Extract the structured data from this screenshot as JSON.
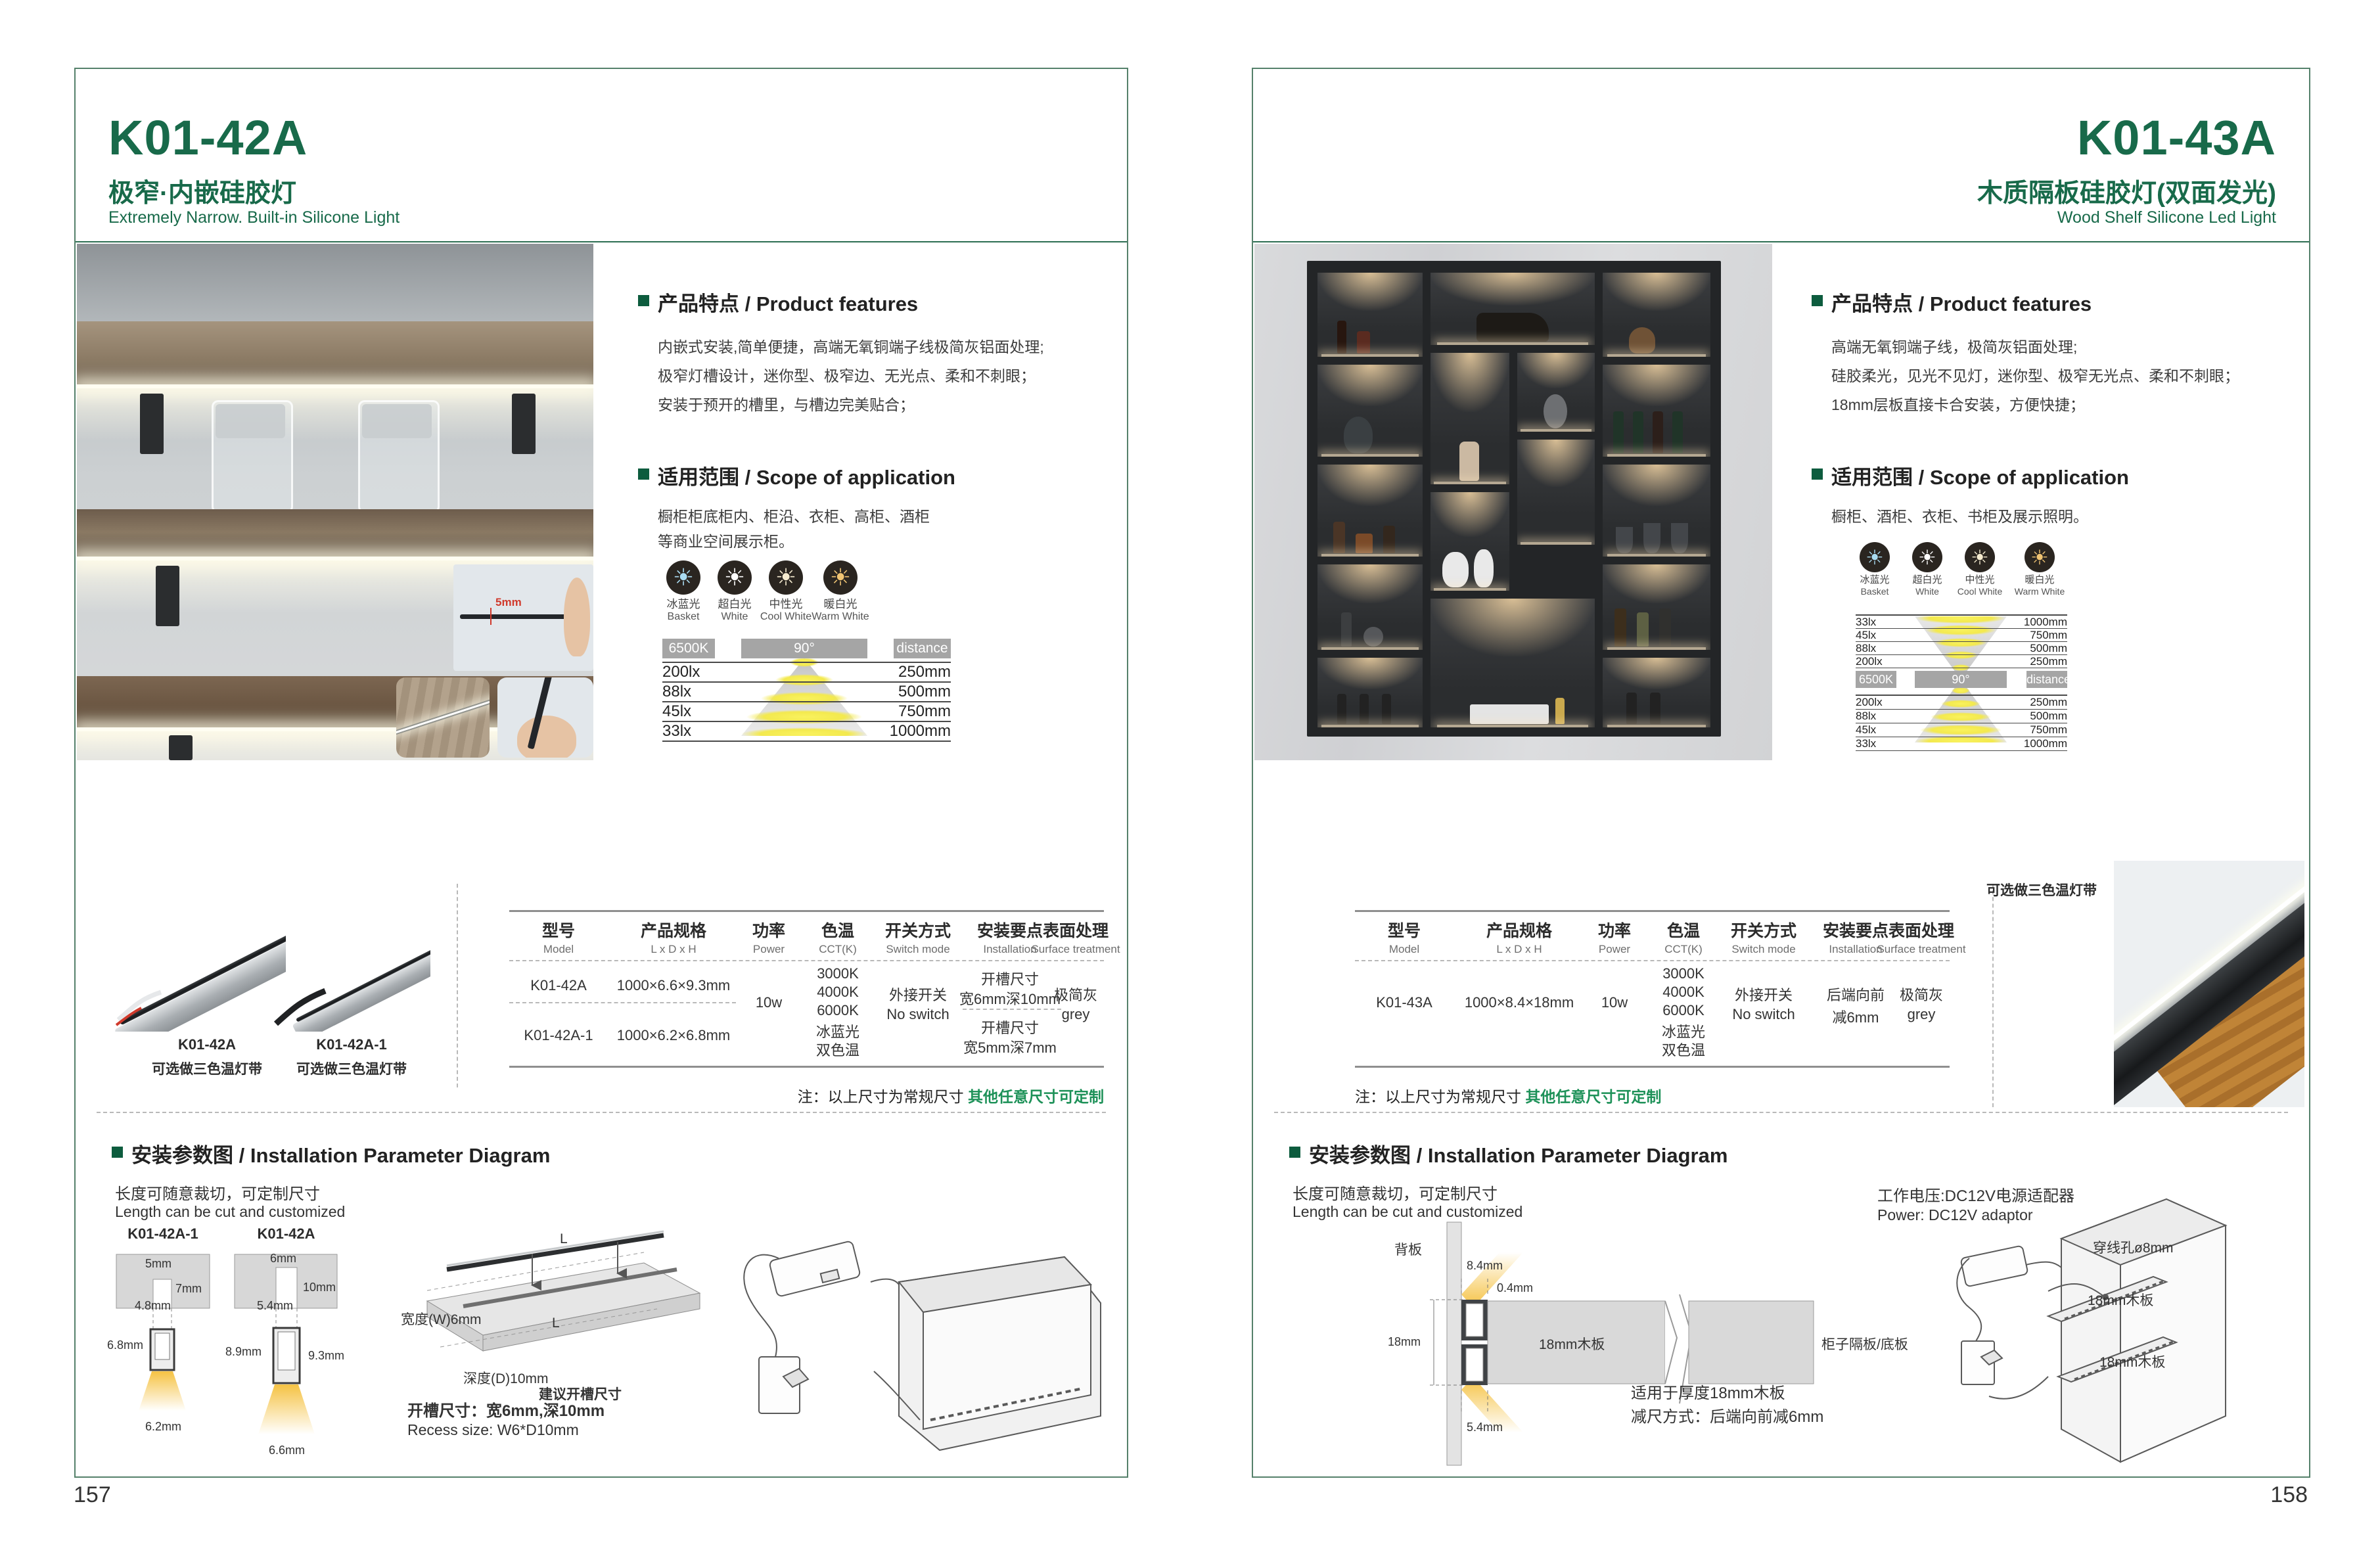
{
  "brand": {
    "accent_green": "#186a4a",
    "bullet_green": "#0d5c3e",
    "note_green": "#1d9158",
    "warm_light": "#f5c243"
  },
  "pages": [
    {
      "page_number": "157",
      "model": "K01-42A",
      "title_cn": "极窄·内嵌硅胶灯",
      "title_en": "Extremely Narrow. Built-in Silicone Light",
      "features": {
        "heading": "产品特点 / Product features",
        "lines": [
          "内嵌式安装,简单便捷，高端无氧铜端子线极简灰铝面处理;",
          "极窄灯槽设计，迷你型、极窄边、无光点、柔和不刺眼；",
          "安装于预开的槽里，与槽边完美贴合；"
        ]
      },
      "scope": {
        "heading": "适用范围 / Scope of application",
        "lines": [
          "橱柜柜底柜内、柜沿、衣柜、高柜、酒柜",
          "等商业空间展示柜。"
        ]
      },
      "photometric": {
        "icons": [
          {
            "cn": "冰蓝光",
            "en": "Basket",
            "color": "#a9dcf2"
          },
          {
            "cn": "超白光",
            "en": "White",
            "color": "#ffffff"
          },
          {
            "cn": "中性光",
            "en": "Cool White",
            "color": "#f6ecd0"
          },
          {
            "cn": "暖白光",
            "en": "Warm White",
            "color": "#f0c473"
          }
        ],
        "kelvin": "6500K",
        "angle": "90°",
        "distance_label": "distance",
        "rows": [
          {
            "lux": "200lx",
            "d": "250mm"
          },
          {
            "lux": "88lx",
            "d": "500mm"
          },
          {
            "lux": "45lx",
            "d": "750mm"
          },
          {
            "lux": "33lx",
            "d": "1000mm"
          }
        ]
      },
      "photo": {
        "inset_dim": "5mm"
      },
      "products": [
        {
          "model": "K01-42A",
          "note": "可选做三色温灯带"
        },
        {
          "model": "K01-42A-1",
          "note": "可选做三色温灯带"
        }
      ],
      "spec_table": {
        "headers": [
          {
            "cn": "型号",
            "en": "Model"
          },
          {
            "cn": "产品规格",
            "en": "L x D x H"
          },
          {
            "cn": "功率",
            "en": "Power"
          },
          {
            "cn": "色温",
            "en": "CCT(K)"
          },
          {
            "cn": "开关方式",
            "en": "Switch mode"
          },
          {
            "cn": "安装要点",
            "en": "Installation"
          },
          {
            "cn": "表面处理",
            "en": "Surface treatment"
          }
        ],
        "models": [
          "K01-42A",
          "K01-42A-1"
        ],
        "sizes": [
          "1000×6.6×9.3mm",
          "1000×6.2×6.8mm"
        ],
        "power": "10w",
        "cct": [
          "3000K",
          "4000K",
          "6000K",
          "冰蓝光",
          "双色温"
        ],
        "switch": [
          "外接开关",
          "No switch"
        ],
        "install": [
          [
            "开槽尺寸",
            "宽6mm深10mm"
          ],
          [
            "开槽尺寸",
            "宽5mm深7mm"
          ]
        ],
        "surface": [
          "极简灰",
          "grey"
        ]
      },
      "note": {
        "prefix": "注：以上尺寸为常规尺寸 ",
        "highlight": "其他任意尺寸可定制"
      },
      "installation": {
        "heading": "安装参数图 / Installation Parameter Diagram",
        "cut_cn": "长度可随意裁切，可定制尺寸",
        "cut_en": "Length can be cut and customized",
        "diagramA": {
          "label": "K01-42A-1",
          "dims": [
            "5mm",
            "7mm",
            "4.8mm",
            "6.8mm",
            "6.2mm"
          ]
        },
        "diagramB": {
          "label": "K01-42A",
          "dims": [
            "6mm",
            "10mm",
            "5.4mm",
            "8.9mm",
            "9.3mm",
            "6.6mm"
          ]
        },
        "slab": {
          "width_label": "宽度(W)6mm",
          "depth_label": "深度(D)10mm",
          "caption": "建议开槽尺寸",
          "l1": "L",
          "l2": "L"
        },
        "recess_cn": "开槽尺寸：宽6mm,深10mm",
        "recess_en": "Recess size: W6*D10mm"
      }
    },
    {
      "page_number": "158",
      "model": "K01-43A",
      "title_cn": "木质隔板硅胶灯(双面发光)",
      "title_en": "Wood Shelf Silicone Led Light",
      "features": {
        "heading": "产品特点 / Product features",
        "lines": [
          "高端无氧铜端子线，极简灰铝面处理;",
          "硅胶柔光，见光不见灯，迷你型、极窄无光点、柔和不刺眼；",
          "18mm层板直接卡合安装，方便快捷；"
        ]
      },
      "scope": {
        "heading": "适用范围 / Scope of application",
        "lines": [
          "橱柜、酒柜、衣柜、书柜及展示照明。"
        ]
      },
      "photometric": {
        "icons": [
          {
            "cn": "冰蓝光",
            "en": "Basket",
            "color": "#a9dcf2"
          },
          {
            "cn": "超白光",
            "en": "White",
            "color": "#ffffff"
          },
          {
            "cn": "中性光",
            "en": "Cool White",
            "color": "#f6ecd0"
          },
          {
            "cn": "暖白光",
            "en": "Warm White",
            "color": "#f0c473"
          }
        ],
        "kelvin": "6500K",
        "angle": "90°",
        "distance_label": "distance",
        "rows_top": [
          {
            "lux": "33lx",
            "d": "1000mm"
          },
          {
            "lux": "45lx",
            "d": "750mm"
          },
          {
            "lux": "88lx",
            "d": "500mm"
          },
          {
            "lux": "200lx",
            "d": "250mm"
          }
        ],
        "rows_bottom": [
          {
            "lux": "200lx",
            "d": "250mm"
          },
          {
            "lux": "88lx",
            "d": "500mm"
          },
          {
            "lux": "45lx",
            "d": "750mm"
          },
          {
            "lux": "33lx",
            "d": "1000mm"
          }
        ]
      },
      "products": [
        {
          "note": "可选做三色温灯带"
        }
      ],
      "spec_table": {
        "headers": [
          {
            "cn": "型号",
            "en": "Model"
          },
          {
            "cn": "产品规格",
            "en": "L x D x H"
          },
          {
            "cn": "功率",
            "en": "Power"
          },
          {
            "cn": "色温",
            "en": "CCT(K)"
          },
          {
            "cn": "开关方式",
            "en": "Switch mode"
          },
          {
            "cn": "安装要点",
            "en": "Installation"
          },
          {
            "cn": "表面处理",
            "en": "Surface treatment"
          }
        ],
        "models": [
          "K01-43A"
        ],
        "sizes": [
          "1000×8.4×18mm"
        ],
        "power": "10w",
        "cct": [
          "3000K",
          "4000K",
          "6000K",
          "冰蓝光",
          "双色温"
        ],
        "switch": [
          "外接开关",
          "No switch"
        ],
        "install": [
          [
            "后端向前",
            "减6mm"
          ]
        ],
        "surface": [
          "极简灰",
          "grey"
        ]
      },
      "note": {
        "prefix": "注：以上尺寸为常规尺寸 ",
        "highlight": "其他任意尺寸可定制"
      },
      "installation": {
        "heading": "安装参数图 / Installation Parameter Diagram",
        "cut_cn": "长度可随意裁切，可定制尺寸",
        "cut_en": "Length can be cut and customized",
        "back_panel_label": "背板",
        "dims": [
          "8.4mm",
          "0.4mm",
          "18mm",
          "5.4mm"
        ],
        "board_label": "18mm木板",
        "shelf_label": "柜子隔板/底板",
        "fit_note": "适用于厚度18mm木板",
        "reduce_note": "减尺方式：后端向前减6mm",
        "power_cn": "工作电压:DC12V电源适配器",
        "power_en": "Power: DC12V adaptor",
        "hole_label": "穿线孔ø8mm",
        "board1": "18mm木板",
        "board2": "18mm木板"
      }
    }
  ]
}
